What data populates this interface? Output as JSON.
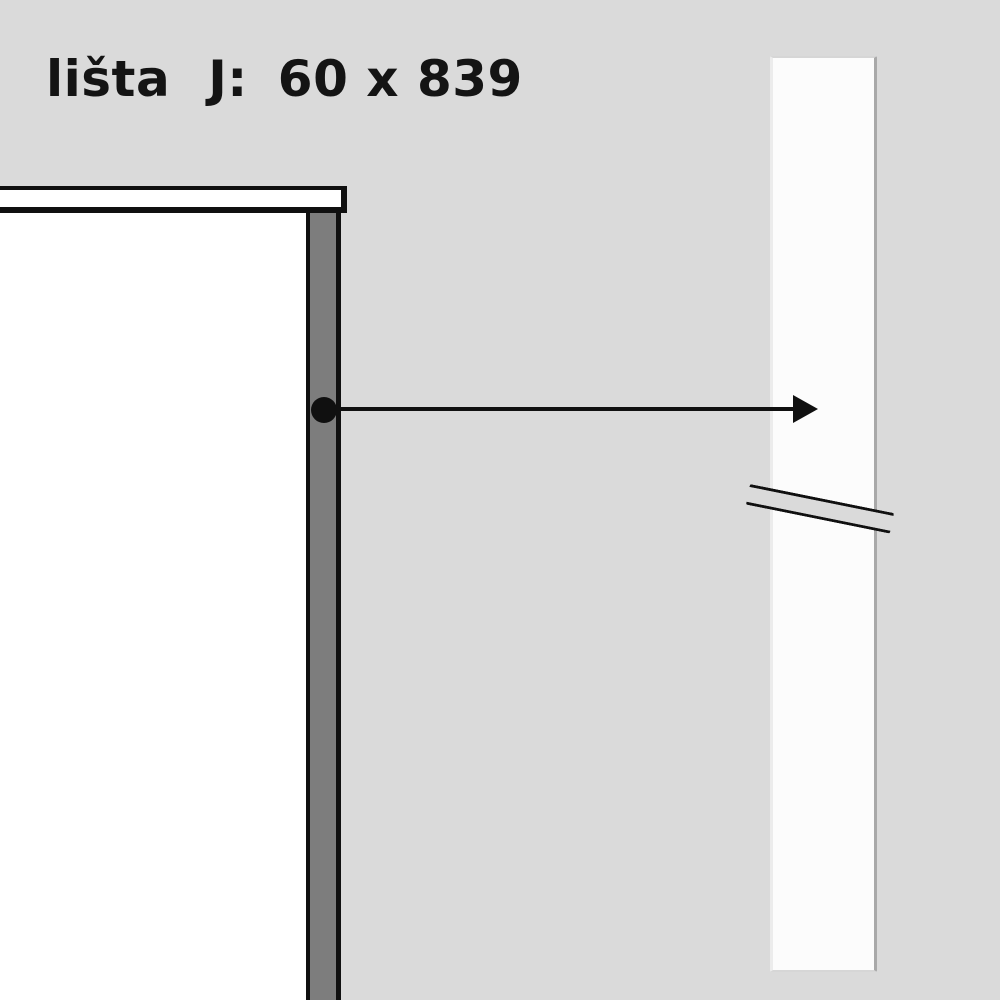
{
  "title": {
    "label": "lišta",
    "code": "J:",
    "dimensions": "60 x 839"
  },
  "colors": {
    "background": "#dadada",
    "outline": "#101010",
    "panel_fill": "#ffffff",
    "strip_fill": "#7d7d7d",
    "bar_fill": "#fcfcfc",
    "bar_edge_left": "#ececec",
    "bar_edge_right": "#a9a9a9",
    "bar_edge_soft": "#d6d6d6",
    "text": "#141414"
  },
  "icons": {
    "reference_dot": "black-dot-marker",
    "leader_arrow": "right-arrow",
    "break_mark": "double-slash-break"
  }
}
